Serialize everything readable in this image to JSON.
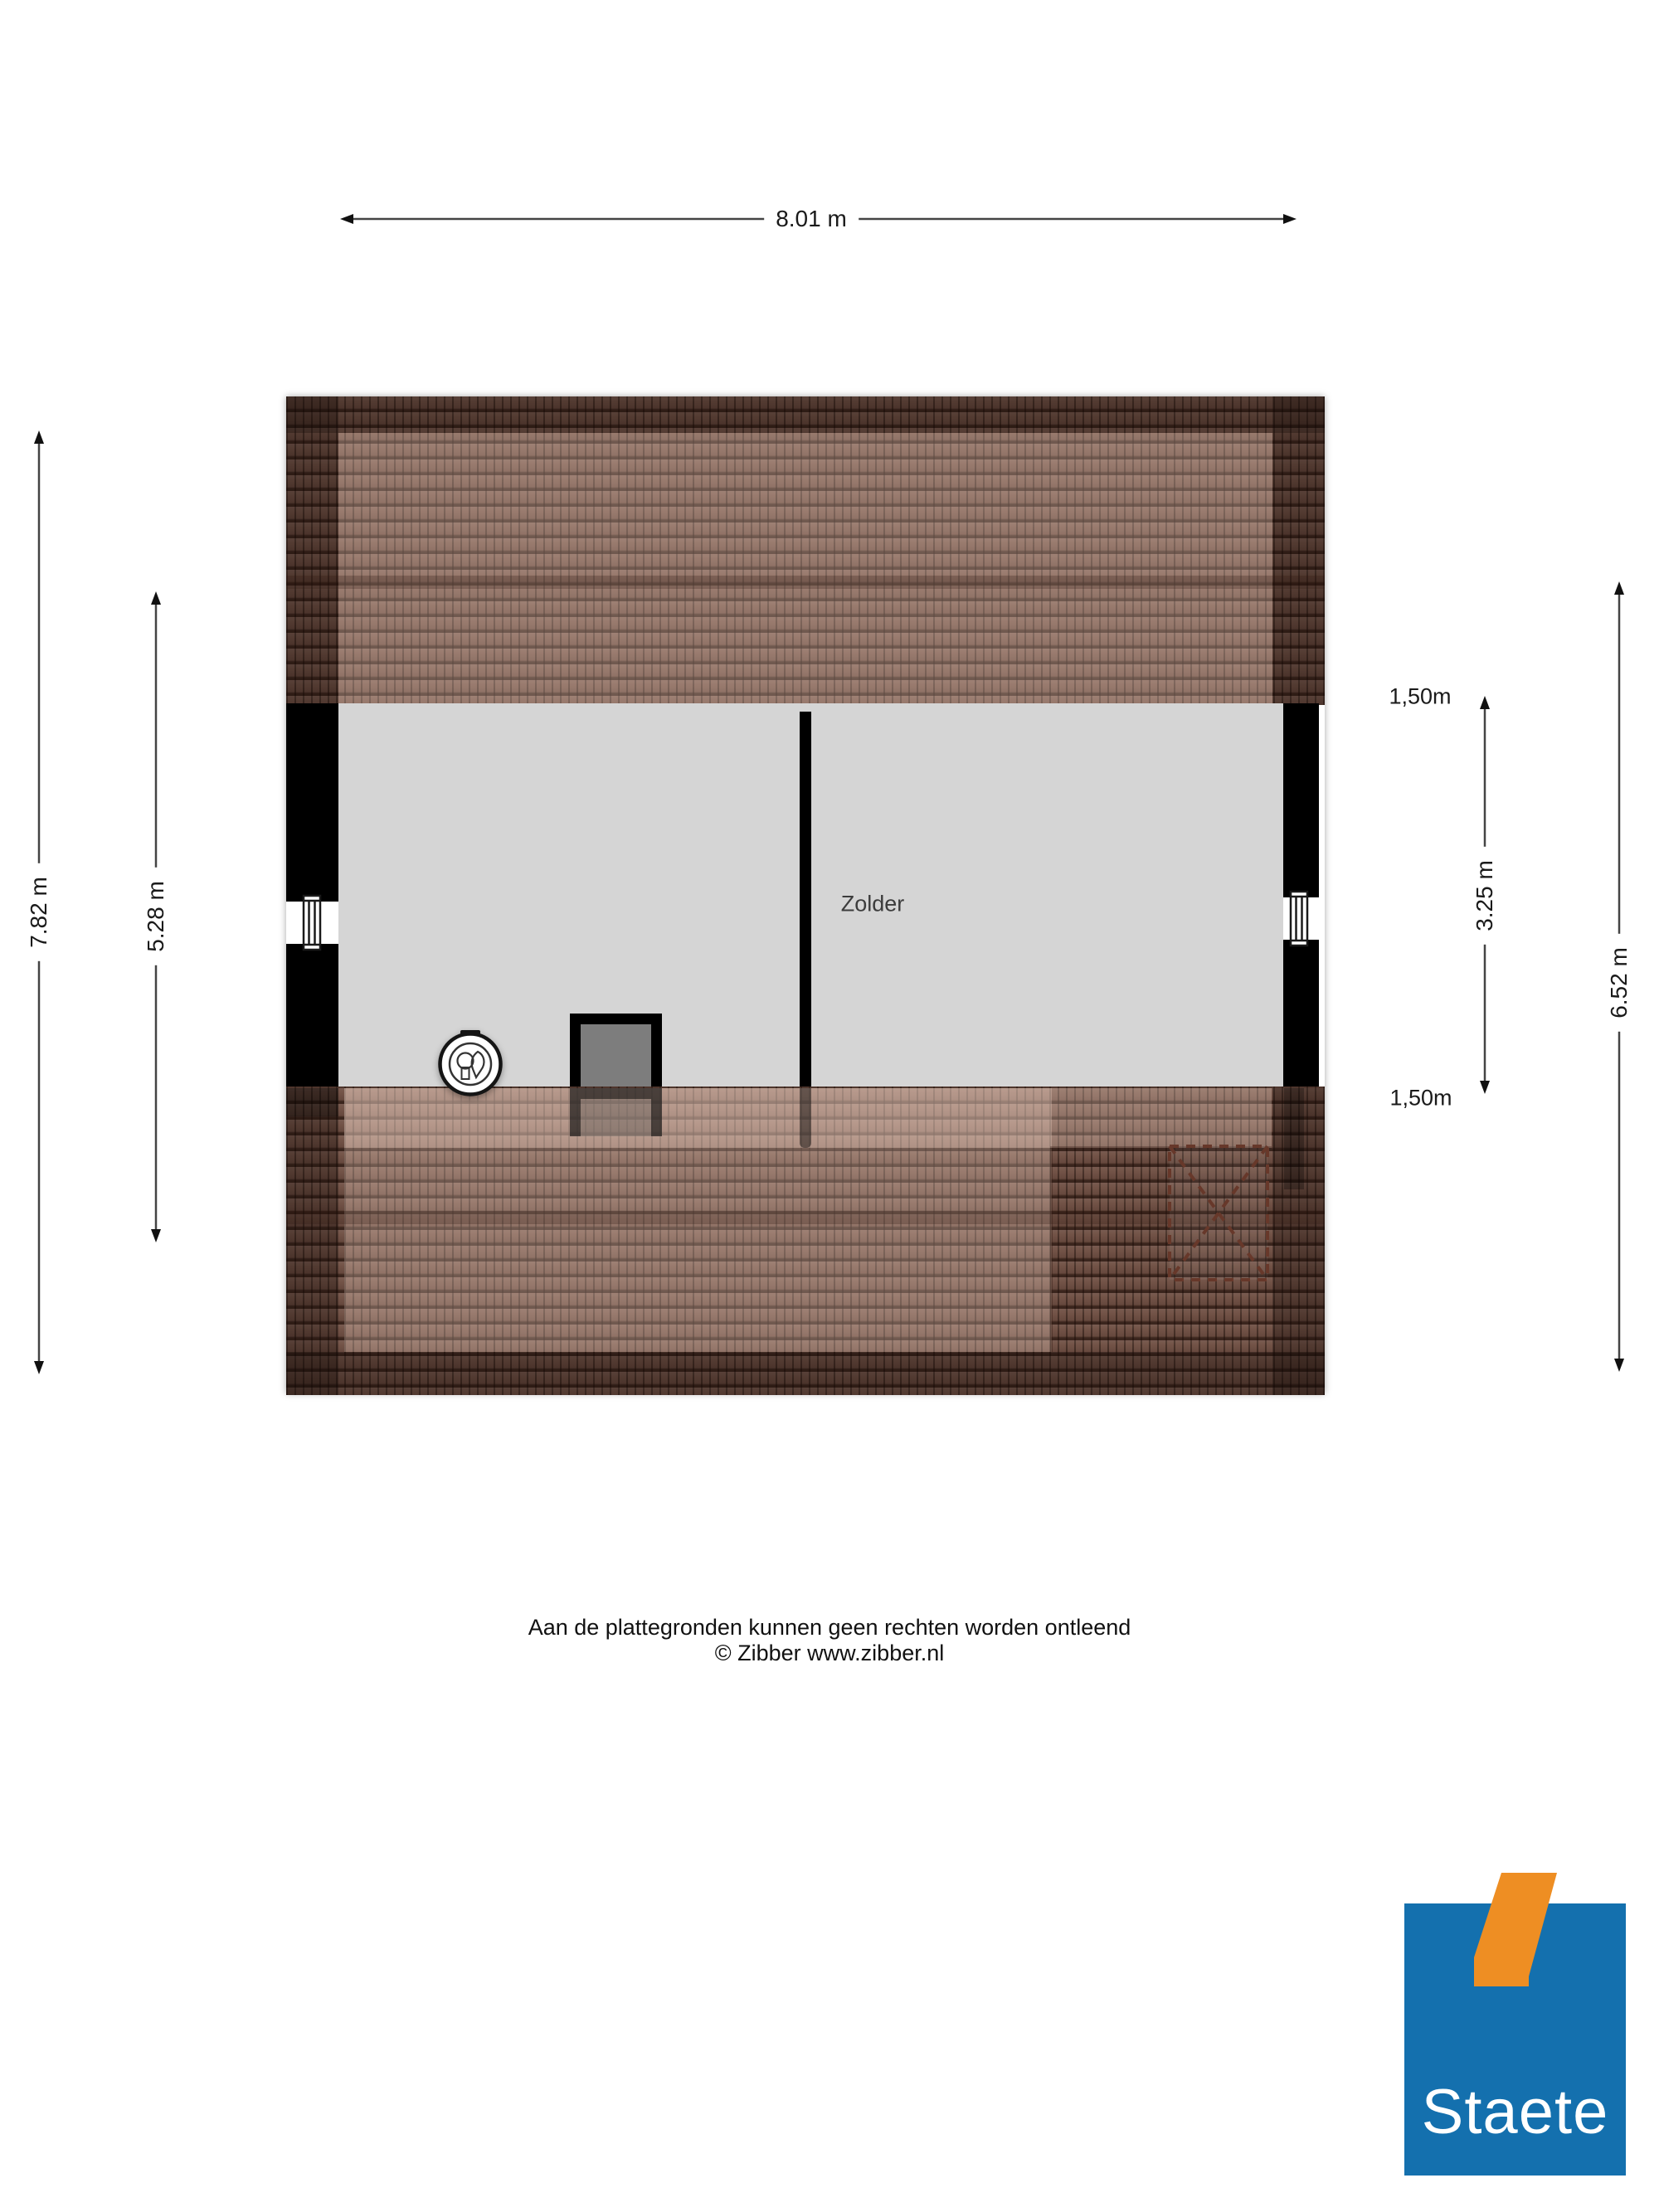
{
  "plan": {
    "room": {
      "label": "Zolder"
    },
    "colors": {
      "roof_base": "#6f4f43",
      "roof_dark": "#513a31",
      "roof_light": "#96705f",
      "floor": "#d5d5d5",
      "wall": "#000000",
      "chimney_interior": "#7d7d7d",
      "skylight_dash": "#67382a"
    },
    "icons": [
      "window-icon",
      "window-icon",
      "mv-unit-icon",
      "skylight-icon"
    ]
  },
  "dimensions": {
    "top_width": {
      "label": "8.01 m"
    },
    "left_outer": {
      "label": "7.82 m"
    },
    "left_inner": {
      "label": "5.28 m"
    },
    "right_offset_top": {
      "label": "1,50m"
    },
    "right_inner": {
      "label": "3.25 m"
    },
    "right_outer": {
      "label": "6.52 m"
    },
    "right_offset_bottom": {
      "label": "1,50m"
    }
  },
  "footer": {
    "disclaimer": "Aan de plattegronden kunnen geen rechten worden ontleend",
    "credit": "© Zibber www.zibber.nl"
  },
  "logo": {
    "text": "Staete",
    "colors": {
      "blue": "#1470ae",
      "orange": "#ee8e23"
    }
  }
}
